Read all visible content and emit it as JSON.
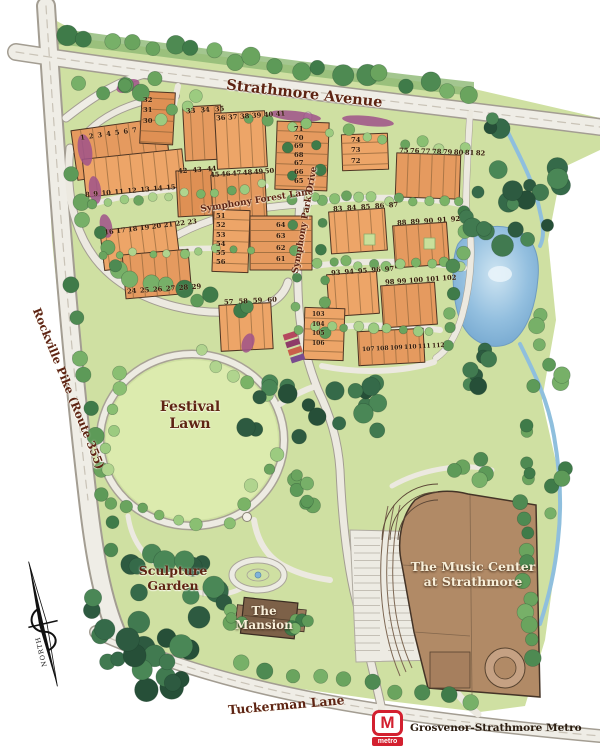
{
  "map": {
    "roads": {
      "strathmore": {
        "label": "Strathmore Avenue"
      },
      "rockville": {
        "label": "Rockville Pike (Route 355)"
      },
      "tuckerman": {
        "label": "Tuckerman Lane"
      },
      "symphony_forest": {
        "label": "Symphony Forest Lane"
      },
      "symphony_park": {
        "label": "Symphony Park Drive"
      }
    },
    "places": {
      "festival_lawn": {
        "line1": "Festival",
        "line2": "Lawn"
      },
      "sculpture_garden": {
        "line1": "Sculpture",
        "line2": "Garden"
      },
      "mansion": {
        "line1": "The",
        "line2": "Mansion"
      },
      "music_center": {
        "line1": "The Music Center",
        "line2": "at Strathmore"
      }
    },
    "metro": {
      "logo_letter": "M",
      "logo_word": "metro",
      "label": "Grosvenor-Strathmore Metro",
      "brand_color": "#d3202f"
    },
    "compass": {
      "label": "NORTH"
    },
    "lot_groups": [
      {
        "name": "lots-1-7",
        "numbers": [
          "1",
          "2",
          "3",
          "4",
          "5",
          "6",
          "7"
        ]
      },
      {
        "name": "lots-8-15",
        "numbers": [
          "8",
          "9",
          "10",
          "11",
          "12",
          "13",
          "14",
          "15"
        ]
      },
      {
        "name": "lots-30-32",
        "numbers": [
          "32",
          "31",
          "30"
        ]
      },
      {
        "name": "lots-33-35",
        "numbers": [
          "33",
          "34",
          "35"
        ]
      },
      {
        "name": "lots-36-41",
        "numbers": [
          "36",
          "37",
          "38",
          "39",
          "40",
          "41"
        ]
      },
      {
        "name": "lots-42-44",
        "numbers": [
          "42",
          "43",
          "44"
        ]
      },
      {
        "name": "lots-45-50",
        "numbers": [
          "45",
          "46",
          "47",
          "48",
          "49",
          "50"
        ]
      },
      {
        "name": "lots-16-23",
        "numbers": [
          "16",
          "17",
          "18",
          "19",
          "20",
          "21",
          "22",
          "23"
        ]
      },
      {
        "name": "lots-24-29",
        "numbers": [
          "24",
          "25",
          "26",
          "27",
          "28",
          "29"
        ]
      },
      {
        "name": "lots-51-56",
        "numbers": [
          "51",
          "52",
          "53",
          "54",
          "55",
          "56"
        ]
      },
      {
        "name": "lots-61-64",
        "numbers": [
          "64",
          "63",
          "62",
          "61"
        ]
      },
      {
        "name": "lots-57-60",
        "numbers": [
          "57",
          "58",
          "59",
          "60"
        ]
      },
      {
        "name": "lots-65-71",
        "numbers": [
          "71",
          "70",
          "69",
          "68",
          "67",
          "66",
          "65"
        ]
      },
      {
        "name": "lots-72-74",
        "numbers": [
          "74",
          "73",
          "72"
        ]
      },
      {
        "name": "lots-75-82",
        "numbers": [
          "75",
          "76",
          "77",
          "78",
          "79",
          "80",
          "81",
          "82"
        ]
      },
      {
        "name": "lots-83-87",
        "numbers": [
          "83",
          "84",
          "85",
          "86",
          "87"
        ]
      },
      {
        "name": "lots-88-92",
        "numbers": [
          "88",
          "89",
          "90",
          "91",
          "92"
        ]
      },
      {
        "name": "lots-93-97",
        "numbers": [
          "93",
          "94",
          "95",
          "96",
          "97"
        ]
      },
      {
        "name": "lots-98-102",
        "numbers": [
          "98",
          "99",
          "100",
          "101",
          "102"
        ]
      },
      {
        "name": "lots-103-106",
        "numbers": [
          "103",
          "104",
          "105",
          "106"
        ]
      },
      {
        "name": "lots-107-112",
        "numbers": [
          "107",
          "108",
          "109",
          "110",
          "111",
          "112"
        ]
      }
    ],
    "colors": {
      "lot_block_orange": "#e59a5f",
      "pond_blue": "#7fb3d9",
      "label_brown": "#5e2413",
      "building_brown": "#b18a66",
      "metro_red": "#d3202f"
    }
  }
}
